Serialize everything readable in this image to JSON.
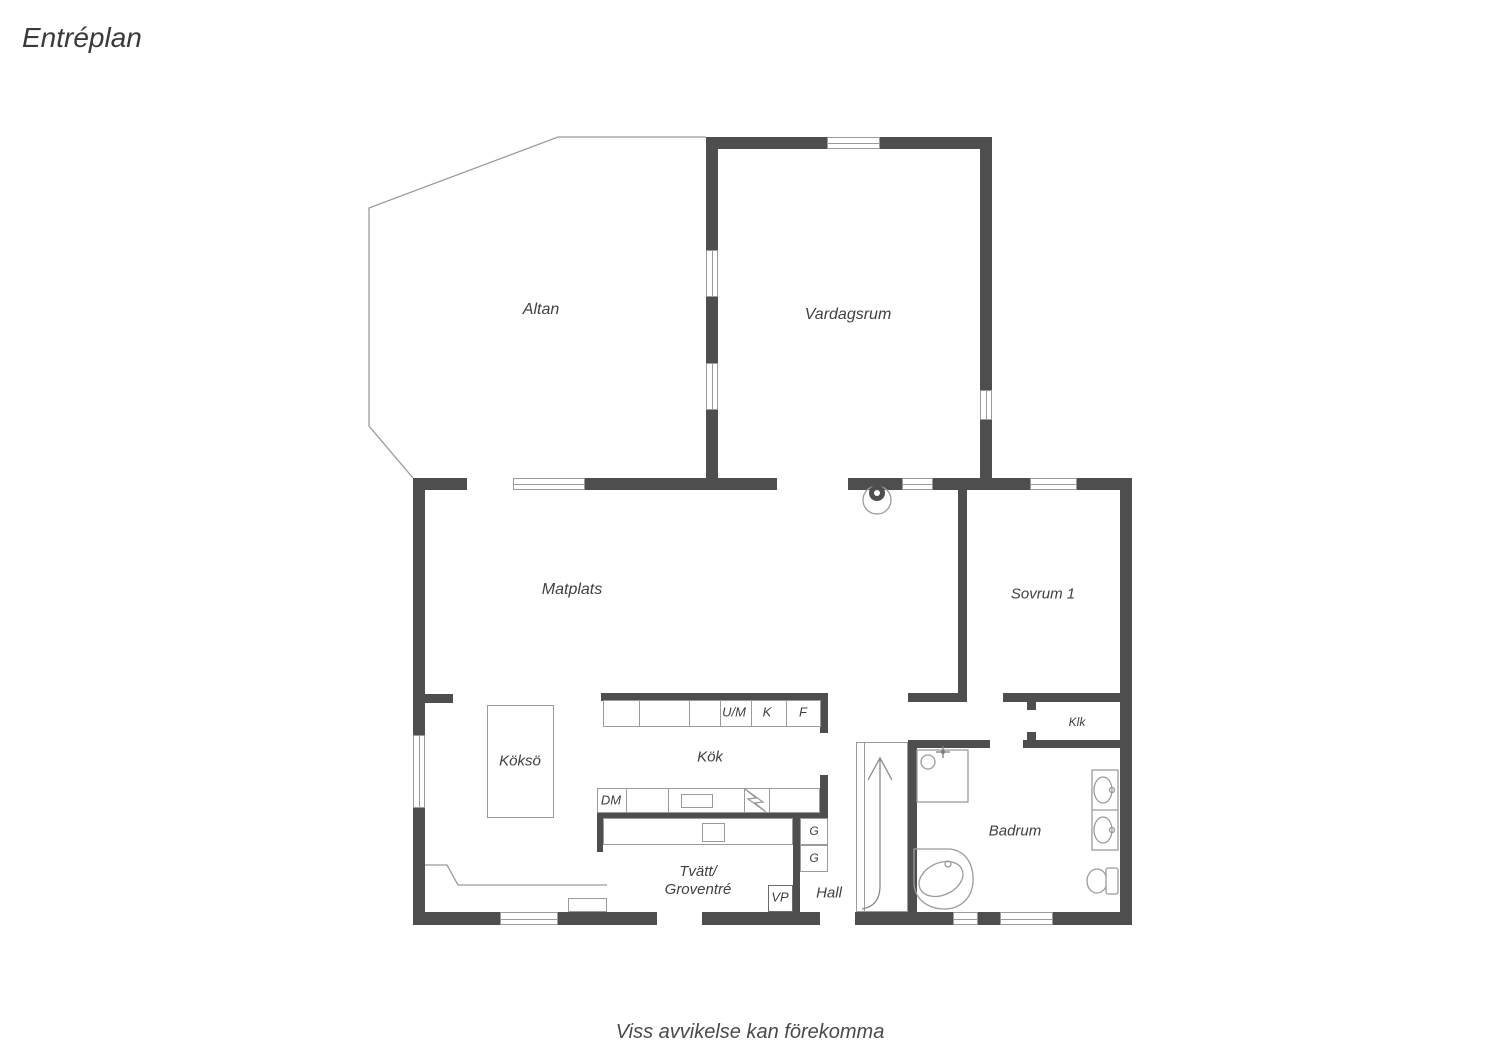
{
  "title": "Entréplan",
  "footer": "Viss avvikelse kan förekomma",
  "colors": {
    "wall": "#4e4e4e",
    "line": "#9b9b9b",
    "text": "#3f3f3f"
  },
  "rooms": {
    "altan": "Altan",
    "vardagsrum": "Vardagsrum",
    "matplats": "Matplats",
    "sovrum1": "Sovrum 1",
    "kokso": "Köksö",
    "kok": "Kök",
    "tvatt_line1": "Tvätt/",
    "tvatt_line2": "Groventré",
    "hall": "Hall",
    "badrum": "Badrum",
    "klk": "Klk"
  },
  "fixtures": {
    "um": "U/M",
    "k": "K",
    "f": "F",
    "dm": "DM",
    "g_upper": "G",
    "g_lower": "G",
    "vp": "VP"
  }
}
